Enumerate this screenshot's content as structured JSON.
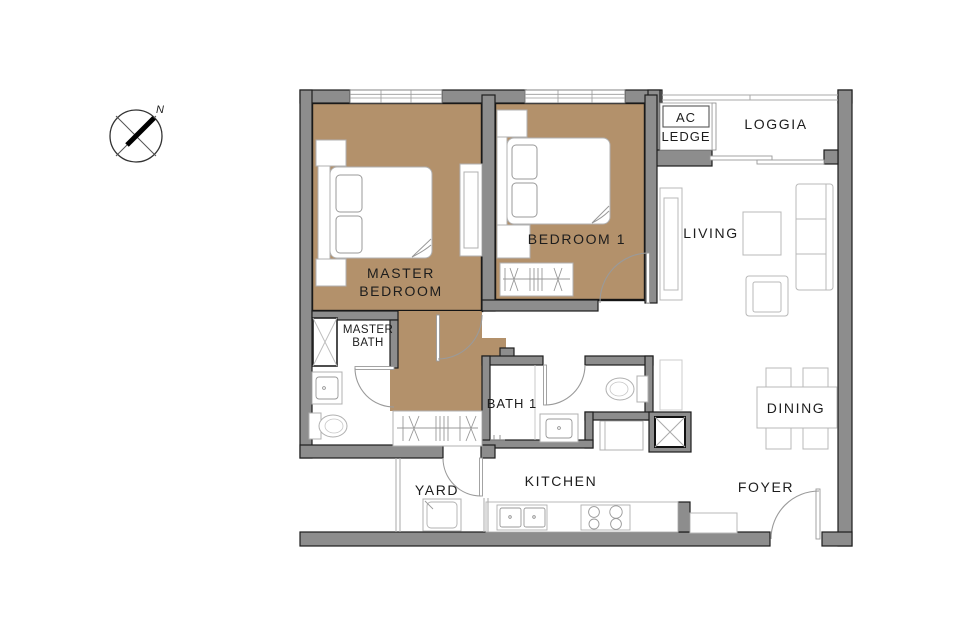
{
  "title": "2-bedroom apartment floor plan",
  "palette": {
    "wall_gray": "#8d8d8d",
    "floor_tan": "#b3916b",
    "outline_black": "#1d1d1d",
    "furniture_gray": "#b0b0b0",
    "background": "#ffffff"
  },
  "compass": {
    "north_label": "N"
  },
  "rooms": {
    "master_bedroom": {
      "label": "MASTER BEDROOM",
      "line1": "MASTER",
      "line2": "BEDROOM"
    },
    "bedroom_1": {
      "label": "BEDROOM 1"
    },
    "master_bath": {
      "label": "MASTER BATH",
      "line1": "MASTER",
      "line2": "BATH"
    },
    "bath_1": {
      "label": "BATH 1"
    },
    "living": {
      "label": "LIVING"
    },
    "dining": {
      "label": "DINING"
    },
    "kitchen": {
      "label": "KITCHEN"
    },
    "yard": {
      "label": "YARD"
    },
    "foyer": {
      "label": "FOYER"
    },
    "loggia": {
      "label": "LOGGIA"
    },
    "ac_ledge": {
      "label": "AC LEDGE",
      "line1": "AC",
      "line2": "LEDGE"
    }
  }
}
